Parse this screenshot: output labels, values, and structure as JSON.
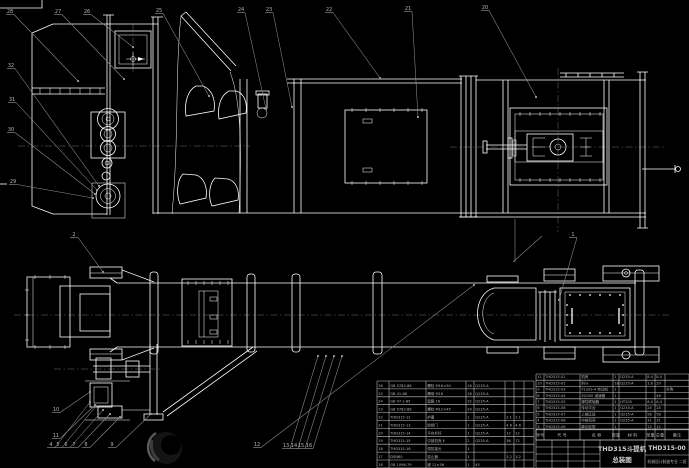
{
  "meta": {
    "drawing_type": "CAD assembly drawing, bucket elevator",
    "background": "#000000",
    "colors": {
      "line": "#ffffff",
      "leader": "#8f8f8f",
      "text": "#b5b5b5",
      "grid": "#c9c9c9"
    }
  },
  "title_block": {
    "title_line1": "THD315斗提机",
    "title_line2": "总装图",
    "drawing_number": "THD315-00",
    "org_line": "机械设计制造专业 二班"
  },
  "bom_header": {
    "labels": [
      "序号",
      "代 号",
      "名 称",
      "数量",
      "材 料",
      "单重",
      "总重",
      "备注"
    ]
  },
  "tables": [
    {
      "name": "bom-left",
      "x_cols": [
        377,
        389,
        426,
        466,
        474,
        505,
        514,
        524,
        534
      ],
      "y0": 381,
      "row_h": 7.9,
      "rows": [
        [
          "26",
          "GB 5782-86",
          "螺栓 M16×50",
          "16",
          "Q235-A",
          "",
          "",
          ""
        ],
        [
          "25",
          "GB 41-86",
          "螺母 M16",
          "16",
          "Q235-A",
          "",
          "",
          ""
        ],
        [
          "24",
          "GB 97.1-85",
          "垫圈 16",
          "32",
          "Q235-A",
          "",
          "",
          ""
        ],
        [
          "23",
          "GB 5782-86",
          "螺栓 M12×45",
          "24",
          "Q235-A",
          "",
          "",
          ""
        ],
        [
          "22",
          "THD315-12",
          "护罩",
          "1",
          "Q235-A",
          "2.1",
          "2.1",
          ""
        ],
        [
          "21",
          "THD315-13",
          "检修门",
          "1",
          "Q235-A",
          "4.6",
          "4.6",
          ""
        ],
        [
          "20",
          "THD315-14",
          "平台栏杆",
          "1",
          "Q235-A",
          "12",
          "12",
          ""
        ],
        [
          "19",
          "THD315-15",
          "中部机壳 Ⅱ",
          "2",
          "Q235-A",
          "36",
          "72",
          ""
        ],
        [
          "18",
          "THD315-16",
          "带扣接头",
          "1",
          "",
          "",
          "",
          ""
        ],
        [
          "17",
          "DSN60",
          "逆止器",
          "1",
          "",
          "3.2",
          "3.2",
          ""
        ],
        [
          "16",
          "GB 1096-79",
          "键 12×56",
          "1",
          "45",
          "",
          "",
          ""
        ]
      ]
    },
    {
      "name": "bom-right",
      "x_cols": [
        536,
        544,
        580,
        613,
        619,
        646,
        655,
        665,
        689
      ],
      "y0": 374,
      "row_h": 6.2,
      "rows": [
        [
          "11",
          "THD315-01",
          "机壳",
          "1",
          "Q235-A",
          "8.4",
          "8.4",
          ""
        ],
        [
          "10",
          "THD315-02",
          "料斗",
          "18",
          "Q235-A",
          "1.6",
          "29",
          ""
        ],
        [
          "9",
          "THD315-03",
          "Y132S-4 电动机",
          "1",
          "",
          "",
          "",
          "外购"
        ],
        [
          "8",
          "THD315-04",
          "ZQ350 减速器",
          "1",
          "",
          "",
          "46",
          ""
        ],
        [
          "7",
          "THD315-05",
          "弹性联轴器",
          "1",
          "HT200",
          "6.4",
          "6.4",
          ""
        ],
        [
          "6",
          "THD315-06",
          "传动平台",
          "1",
          "Q235-A",
          "24",
          "24",
          ""
        ],
        [
          "5",
          "THD315-07",
          "上部区段",
          "1",
          "Q235-A",
          "58",
          "58",
          ""
        ],
        [
          "4",
          "THD315-08",
          "中部机壳",
          "1",
          "Q235-A",
          "31",
          "31",
          ""
        ],
        [
          "3",
          "THD315-09",
          "牵引胶带",
          "1",
          "",
          "12",
          "12",
          ""
        ]
      ]
    }
  ],
  "balloons": [
    {
      "label": "28",
      "x": 10,
      "y": 13,
      "lx": 78,
      "ly": 81
    },
    {
      "label": "27",
      "x": 58,
      "y": 13,
      "lx": 124,
      "ly": 79
    },
    {
      "label": "26",
      "x": 87,
      "y": 13,
      "lx": 133,
      "ly": 47
    },
    {
      "label": "25",
      "x": 159,
      "y": 12,
      "lx": 209,
      "ly": 96
    },
    {
      "label": "24",
      "x": 241,
      "y": 11,
      "lx": 266,
      "ly": 109
    },
    {
      "label": "23",
      "x": 269,
      "y": 11,
      "lx": 292,
      "ly": 107
    },
    {
      "label": "22",
      "x": 329,
      "y": 11,
      "lx": 380,
      "ly": 78
    },
    {
      "label": "21",
      "x": 408,
      "y": 10,
      "lx": 418,
      "ly": 117
    },
    {
      "label": "20",
      "x": 485,
      "y": 9,
      "lx": 536,
      "ly": 97
    },
    {
      "label": "32",
      "x": 11,
      "y": 67,
      "lx": 99,
      "ly": 186
    },
    {
      "label": "31",
      "x": 12,
      "y": 101,
      "lx": 97,
      "ly": 190
    },
    {
      "label": "30",
      "x": 11,
      "y": 131,
      "lx": 95,
      "ly": 194
    },
    {
      "label": "29",
      "x": 13,
      "y": 183,
      "lx": 93,
      "ly": 198
    },
    {
      "label": "2",
      "x": 74,
      "y": 236,
      "lx": 103,
      "ly": 272
    },
    {
      "label": "1",
      "x": 573,
      "y": 236,
      "lx": 559,
      "ly": 300
    },
    {
      "label": "10",
      "x": 56,
      "y": 411,
      "lx": 90,
      "ly": 392
    },
    {
      "label": "11",
      "x": 56,
      "y": 437,
      "lx": 95,
      "ly": 405
    },
    {
      "label": "4",
      "x": 51,
      "y": 446,
      "lx": 90,
      "ly": 402
    },
    {
      "label": "5",
      "x": 58,
      "y": 446,
      "lx": 96,
      "ly": 406
    },
    {
      "label": "6",
      "x": 66,
      "y": 446,
      "lx": 103,
      "ly": 410
    },
    {
      "label": "7",
      "x": 74,
      "y": 446,
      "lx": 110,
      "ly": 414
    },
    {
      "label": "8",
      "x": 86,
      "y": 446,
      "lx": 120,
      "ly": 417
    },
    {
      "label": "9",
      "x": 112,
      "y": 446,
      "lx": 151,
      "ly": 414
    },
    {
      "label": "12",
      "x": 257,
      "y": 446,
      "lx": 474,
      "ly": 285
    },
    {
      "label": "13",
      "x": 286,
      "y": 447,
      "lx": 318,
      "ly": 356
    },
    {
      "label": "14",
      "x": 294,
      "y": 447,
      "lx": 326,
      "ly": 356
    },
    {
      "label": "15",
      "x": 301,
      "y": 447,
      "lx": 334,
      "ly": 356
    },
    {
      "label": "16",
      "x": 309,
      "y": 447,
      "lx": 342,
      "ly": 356
    }
  ]
}
